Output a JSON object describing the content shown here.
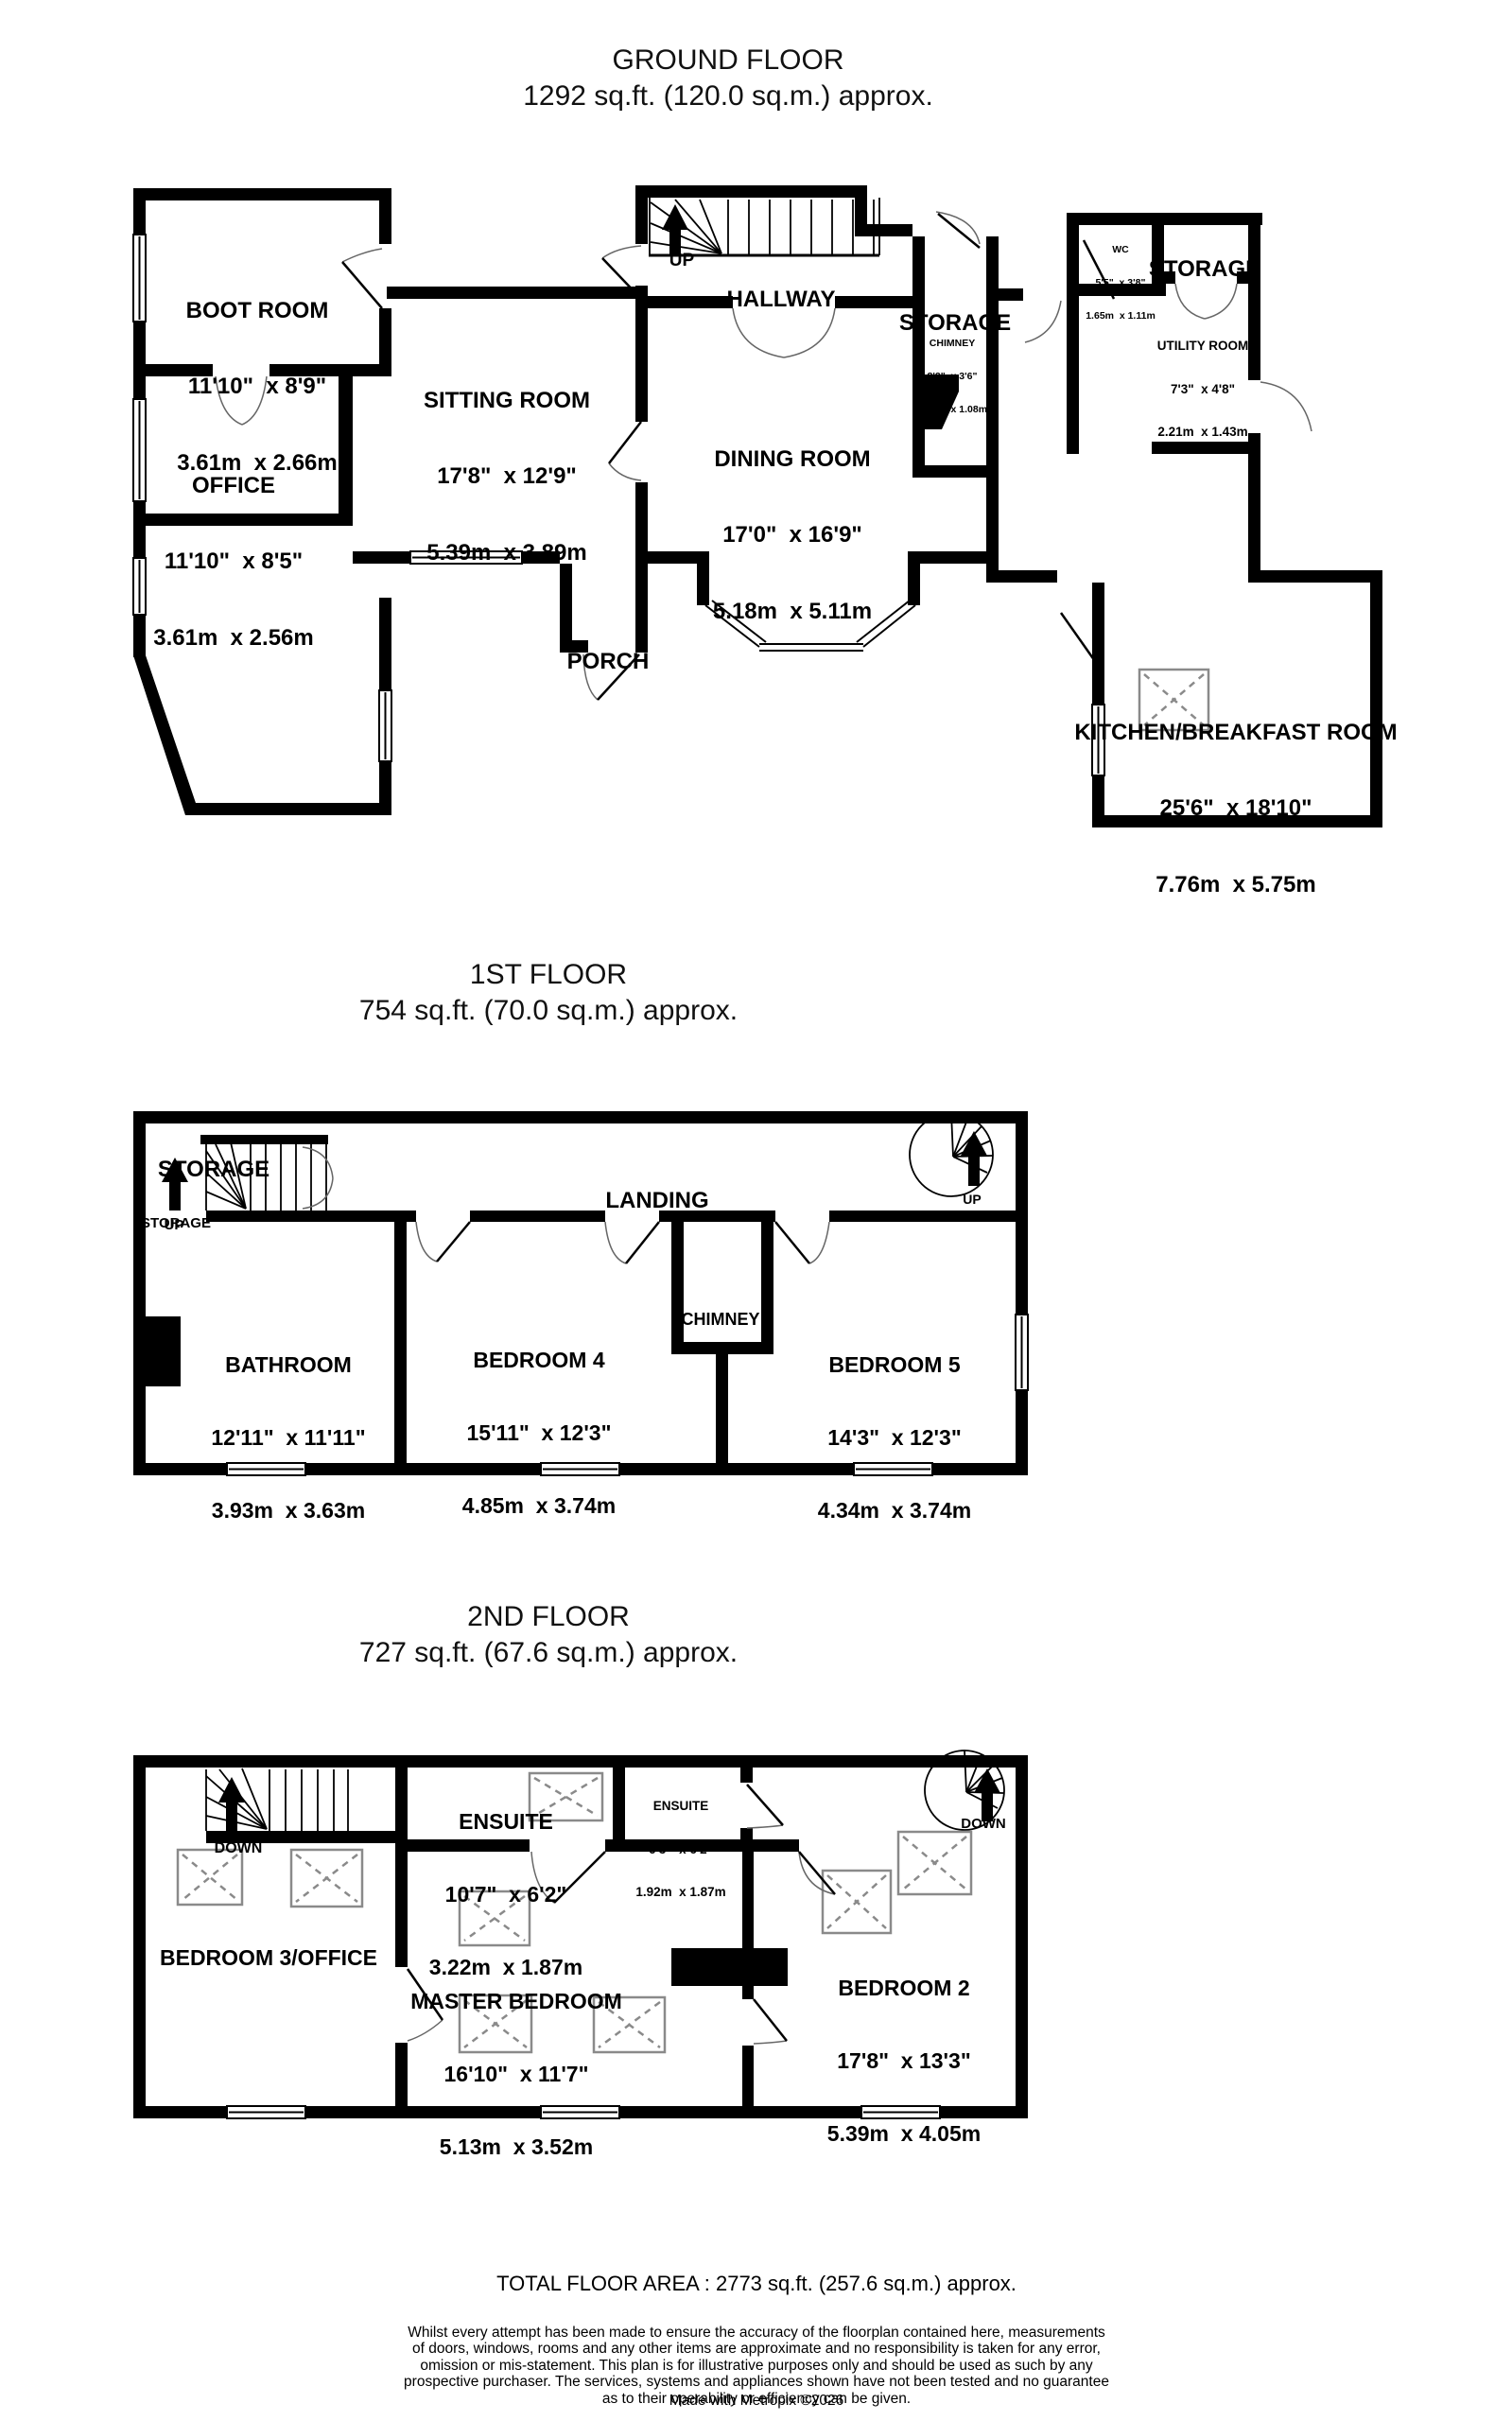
{
  "titles": {
    "ground": {
      "name": "GROUND FLOOR",
      "area": "1292 sq.ft. (120.0 sq.m.) approx."
    },
    "first": {
      "name": "1ST FLOOR",
      "area": "754 sq.ft. (70.0 sq.m.) approx."
    },
    "second": {
      "name": "2ND FLOOR",
      "area": "727 sq.ft. (67.6 sq.m.) approx."
    }
  },
  "nav": {
    "up": "UP",
    "down": "DOWN"
  },
  "rooms": {
    "ground": {
      "boot_room": {
        "name": "BOOT ROOM",
        "imperial": "11'10\"  x 8'9\"",
        "metric": "3.61m  x 2.66m"
      },
      "office": {
        "name": "OFFICE",
        "imperial": "11'10\"  x 8'5\"",
        "metric": "3.61m  x 2.56m"
      },
      "sitting_room": {
        "name": "SITTING ROOM",
        "imperial": "17'8\"  x 12'9\"",
        "metric": "5.39m  x 3.89m"
      },
      "hallway": {
        "name": "HALLWAY"
      },
      "dining_room": {
        "name": "DINING ROOM",
        "imperial": "17'0\"  x 16'9\"",
        "metric": "5.18m  x 5.11m"
      },
      "storage_mid": {
        "name": "STORAGE"
      },
      "chimney": {
        "name": "CHIMNEY",
        "imperial": "8'2\"  x 3'6\"",
        "metric": "2.49m  x 1.08m"
      },
      "wc": {
        "name": "WC",
        "imperial": "5'5\"  x 3'8\"",
        "metric": "1.65m  x 1.11m"
      },
      "storage_top": {
        "name": "STORAGE"
      },
      "utility": {
        "name": "UTILITY ROOM",
        "imperial": "7'3\"  x 4'8\"",
        "metric": "2.21m  x 1.43m"
      },
      "porch": {
        "name": "PORCH"
      },
      "kitchen": {
        "name": "KITCHEN/BREAKFAST ROOM",
        "imperial": "25'6\"  x 18'10\"",
        "metric": "7.76m  x 5.75m"
      }
    },
    "first": {
      "storage_main": {
        "name": "STORAGE"
      },
      "storage_small": {
        "name": "STORAGE"
      },
      "landing": {
        "name": "LANDING"
      },
      "bathroom": {
        "name": "BATHROOM",
        "imperial": "12'11\"  x 11'11\"",
        "metric": "3.93m  x 3.63m"
      },
      "bedroom4": {
        "name": "BEDROOM 4",
        "imperial": "15'11\"  x 12'3\"",
        "metric": "4.85m  x 3.74m"
      },
      "chimney": {
        "name": "CHIMNEY"
      },
      "bedroom5": {
        "name": "BEDROOM 5",
        "imperial": "14'3\"  x 12'3\"",
        "metric": "4.34m  x 3.74m"
      }
    },
    "second": {
      "ensuite1": {
        "name": "ENSUITE",
        "imperial": "10'7\"  x 6'2\"",
        "metric": "3.22m  x 1.87m"
      },
      "ensuite2": {
        "name": "ENSUITE",
        "imperial": "6'3\"  x 6'2\"",
        "metric": "1.92m  x 1.87m"
      },
      "bedroom3": {
        "name": "BEDROOM 3/OFFICE"
      },
      "master": {
        "name": "MASTER BEDROOM",
        "imperial": "16'10\"  x 11'7\"",
        "metric": "5.13m  x 3.52m"
      },
      "bedroom2": {
        "name": "BEDROOM 2",
        "imperial": "17'8\"  x 13'3\"",
        "metric": "5.39m  x 4.05m"
      }
    }
  },
  "footer": {
    "total": "TOTAL FLOOR AREA : 2773 sq.ft. (257.6 sq.m.) approx.",
    "disclaimer": "Whilst every attempt has been made to ensure the accuracy of the floorplan contained here, measurements\nof doors, windows, rooms and any other items are approximate and no responsibility is taken for any error,\nomission or mis-statement. This plan is for illustrative purposes only and should be used as such by any\nprospective purchaser. The services, systems and appliances shown have not been tested and no guarantee\nas to their operability or efficiency can be given.",
    "credit": "Made with Metropix ©2026"
  },
  "colors": {
    "wall": "#000000",
    "skylight": "#8a8a8a",
    "door_arc": "#666666"
  }
}
